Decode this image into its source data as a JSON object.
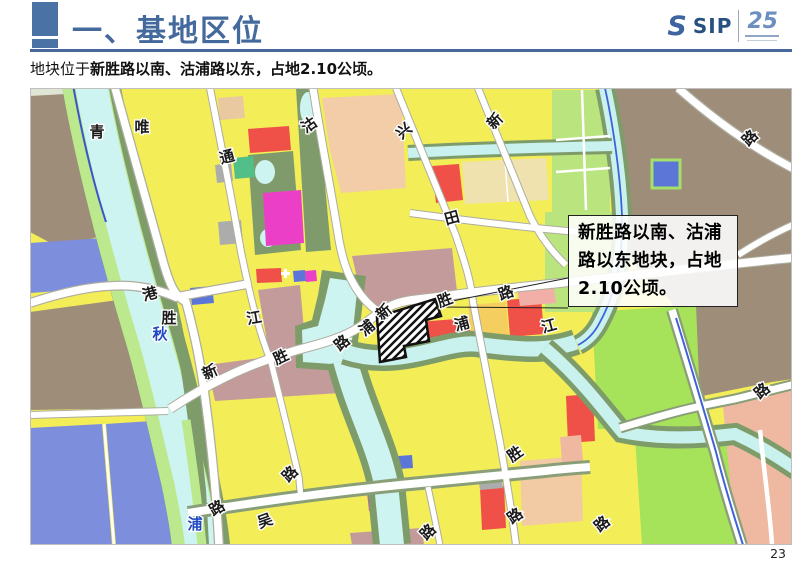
{
  "header": {
    "title": "一、基地区位",
    "logo": {
      "s_mark": "S",
      "sip": "SIP",
      "anniversary": "25"
    }
  },
  "subtitle": {
    "prefix": "地块位于",
    "emphasis": "新胜路以南、沽浦路以东",
    "suffix": "，占地2.10公顷。"
  },
  "map": {
    "callout": {
      "line1": "新胜路以南、沽浦",
      "line2": "路以东地块，占地",
      "line3": "2.10公顷。"
    },
    "labels": [
      {
        "t": "青"
      },
      {
        "t": "唯"
      },
      {
        "t": "沽"
      },
      {
        "t": "通"
      },
      {
        "t": "兴"
      },
      {
        "t": "新"
      },
      {
        "t": "路"
      },
      {
        "t": "田"
      },
      {
        "t": "港"
      },
      {
        "t": "胜"
      },
      {
        "t": "秋"
      },
      {
        "t": "江"
      },
      {
        "t": "新"
      },
      {
        "t": "胜"
      },
      {
        "t": "路"
      },
      {
        "t": "浦"
      },
      {
        "t": "新"
      },
      {
        "t": "胜"
      },
      {
        "t": "路"
      },
      {
        "t": "浦"
      },
      {
        "t": "江"
      },
      {
        "t": "浦"
      },
      {
        "t": "路"
      },
      {
        "t": "吴"
      },
      {
        "t": "路"
      },
      {
        "t": "路"
      },
      {
        "t": "胜"
      },
      {
        "t": "路"
      },
      {
        "t": "路"
      },
      {
        "t": "路"
      }
    ]
  },
  "page_number": "23",
  "colors": {
    "accent_blue": "#46699c",
    "title_blue": "#44699d",
    "map_yellow": "#f3ed58",
    "map_brown": "#9e8d79",
    "map_water": "#cdf4f1",
    "map_olive": "#7e9c6a",
    "map_lightgreen": "#bce98e",
    "map_brightgreen": "#a6e25a",
    "map_blue_parcel": "#7c8edc",
    "map_red": "#ef5148",
    "map_magenta": "#ec3fc8",
    "map_mauve": "#c49b9b",
    "map_salmon": "#efb9a1",
    "map_peach": "#f2cda8",
    "map_orange": "#f5ce60",
    "river_label_blue": "#2148c0"
  }
}
